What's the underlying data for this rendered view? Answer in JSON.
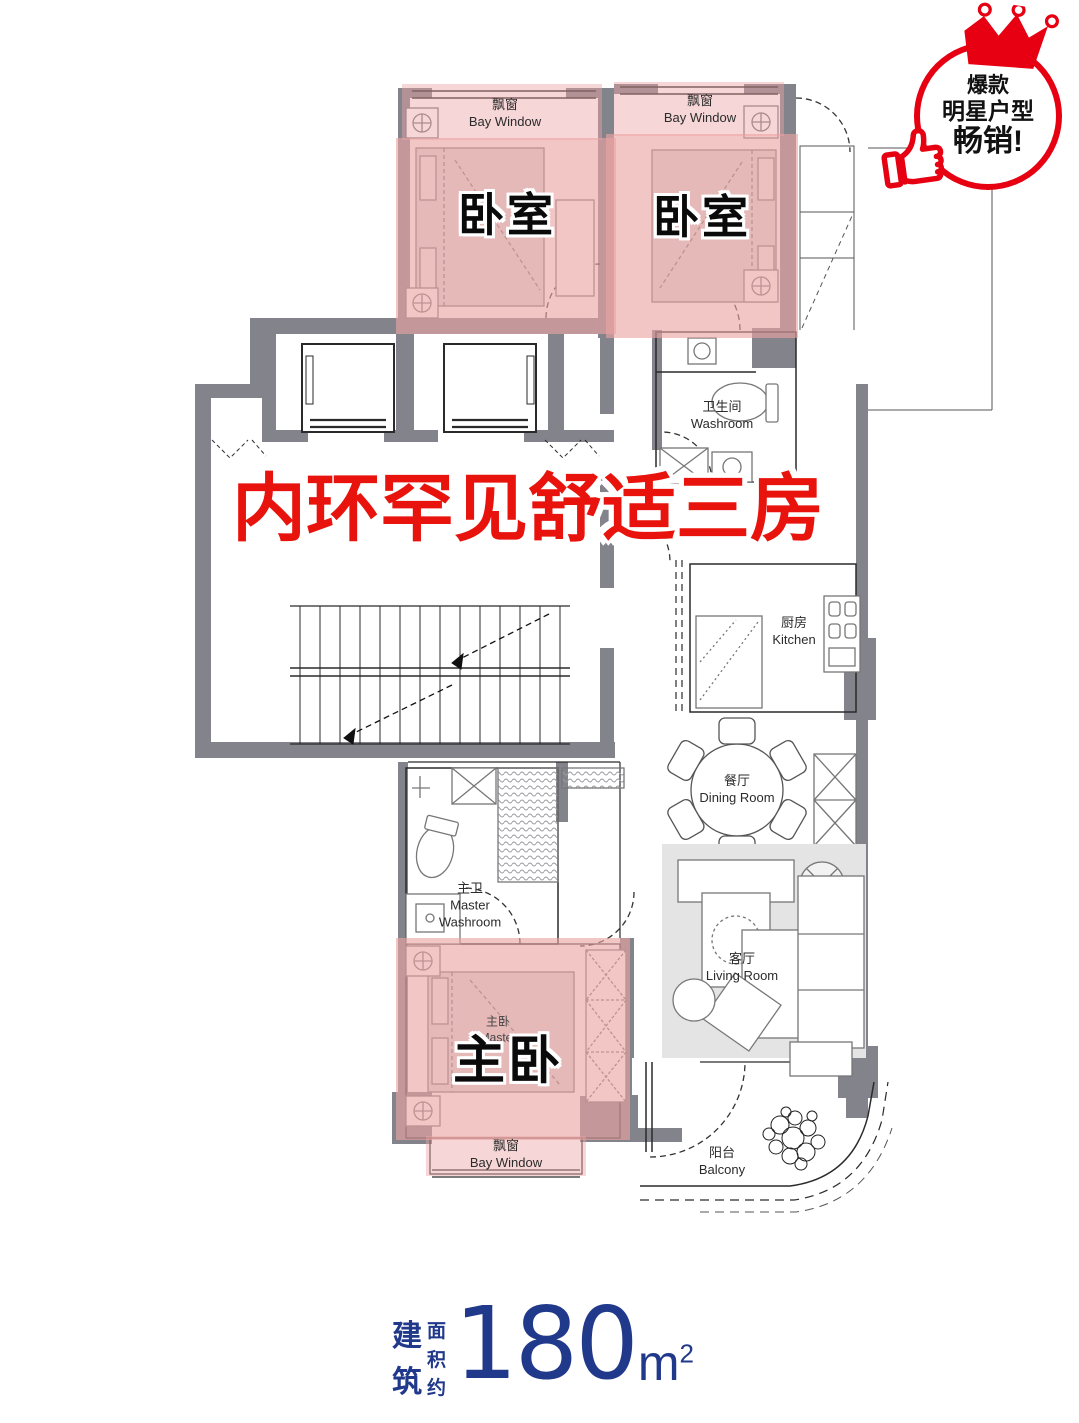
{
  "badge": {
    "line1": "爆款",
    "line2": "明星户型",
    "line3": "畅销!"
  },
  "headline": "内环罕见舒适三房",
  "plan": {
    "bedroom_left": {
      "name": "卧室",
      "bay_zh": "飘窗",
      "bay_en": "Bay Window"
    },
    "bedroom_right": {
      "name": "卧室",
      "bay_zh": "飘窗",
      "bay_en": "Bay Window"
    },
    "washroom": {
      "zh": "卫生间",
      "en": "Washroom"
    },
    "kitchen": {
      "zh": "厨房",
      "en": "Kitchen"
    },
    "dining_room": {
      "zh": "餐厅",
      "en": "Dining Room"
    },
    "living_room": {
      "zh": "客厅",
      "en": "Living Room"
    },
    "master_washroom": {
      "zh": "主卫",
      "en": "Master Washroom"
    },
    "master_bedroom": {
      "name": "主卧",
      "small_zh": "主卧",
      "small_en": "Master",
      "bay_zh": "飘窗",
      "bay_en": "Bay Window"
    },
    "balcony": {
      "zh": "阳台",
      "en": "Balcony"
    }
  },
  "area": {
    "prefix_col1": [
      "建",
      "筑"
    ],
    "prefix_col2": [
      "面",
      "积",
      "约"
    ],
    "value": "180",
    "unit": "m",
    "sup": "2"
  },
  "colors": {
    "accent_red": "#e60012",
    "navy": "#21398b",
    "room_pink": "#eba3a3",
    "wall_gray": "#83838b"
  }
}
